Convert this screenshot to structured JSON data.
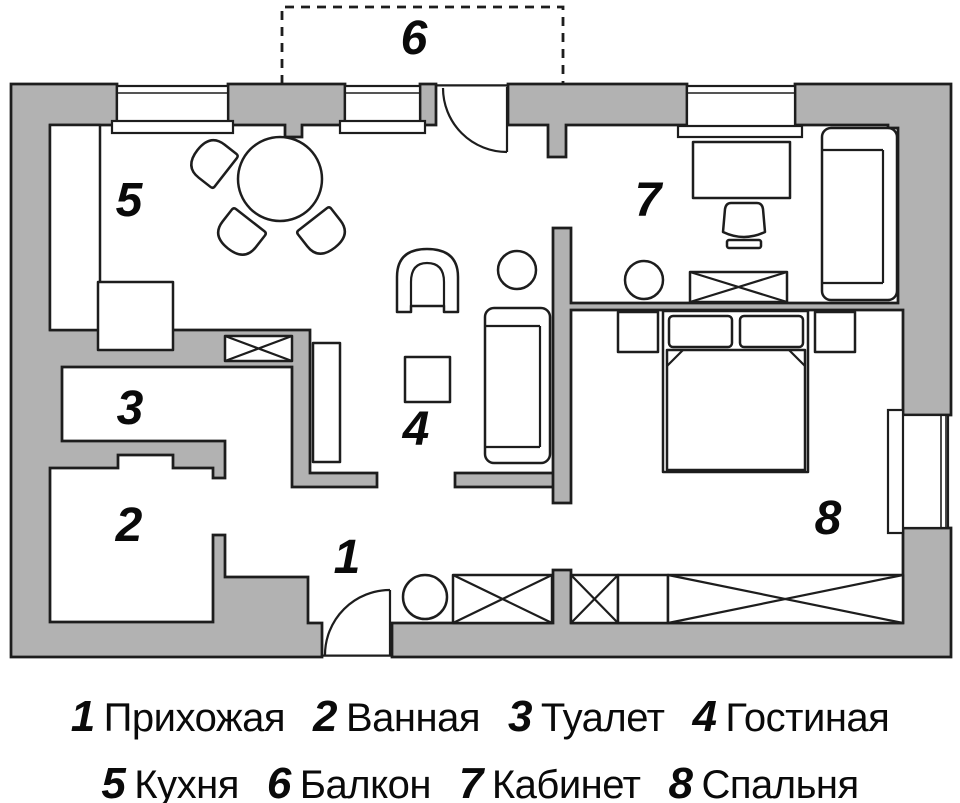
{
  "colors": {
    "wall": "#b2b2b2",
    "line": "#1d1d1d",
    "floor": "#ffffff"
  },
  "rooms": [
    {
      "num": "1",
      "name": "Прихожая"
    },
    {
      "num": "2",
      "name": "Ванная"
    },
    {
      "num": "3",
      "name": "Туалет"
    },
    {
      "num": "4",
      "name": "Гостиная"
    },
    {
      "num": "5",
      "name": "Кухня"
    },
    {
      "num": "6",
      "name": "Балкон"
    },
    {
      "num": "7",
      "name": "Кабинет"
    },
    {
      "num": "8",
      "name": "Спальня"
    }
  ]
}
